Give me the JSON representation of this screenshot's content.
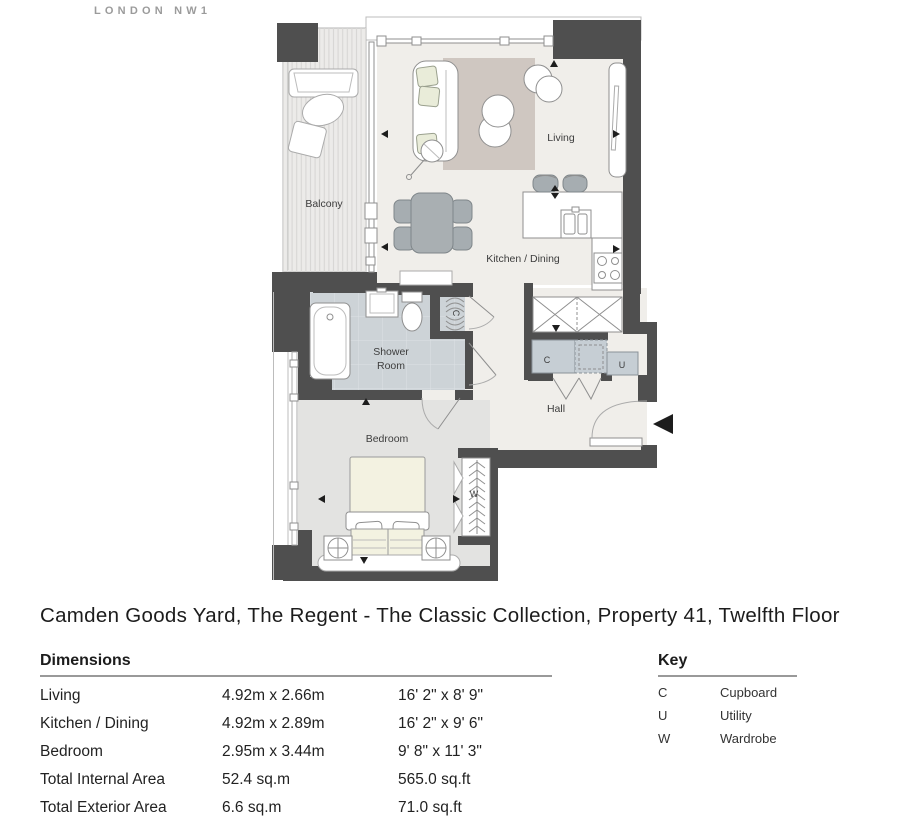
{
  "brand": {
    "location": "LONDON NW1"
  },
  "title": "Camden Goods Yard, The Regent - The Classic Collection, Property 41, Twelfth Floor",
  "plan": {
    "rooms": {
      "balcony": "Balcony",
      "living": "Living",
      "kitchen_dining": "Kitchen / Dining",
      "shower_line1": "Shower",
      "shower_line2": "Room",
      "bedroom": "Bedroom",
      "hall": "Hall"
    },
    "markers": {
      "closet_c": "C",
      "hall_cupboard_c": "C",
      "utility_u": "U",
      "wardrobe_w": "W"
    }
  },
  "dimensions": {
    "heading": "Dimensions",
    "rows": [
      {
        "label": "Living",
        "metric": "4.92m x 2.66m",
        "imperial": "16' 2\" x 8' 9\""
      },
      {
        "label": "Kitchen / Dining",
        "metric": "4.92m x 2.89m",
        "imperial": "16' 2\" x 9' 6\""
      },
      {
        "label": "Bedroom",
        "metric": "2.95m x 3.44m",
        "imperial": "9' 8\" x 11' 3\""
      },
      {
        "label": "Total Internal Area",
        "metric": "52.4 sq.m",
        "imperial": "565.0 sq.ft"
      },
      {
        "label": "Total Exterior Area",
        "metric": "6.6 sq.m",
        "imperial": "71.0 sq.ft"
      }
    ]
  },
  "key": {
    "heading": "Key",
    "items": [
      {
        "symbol": "C",
        "label": "Cupboard"
      },
      {
        "symbol": "U",
        "label": "Utility"
      },
      {
        "symbol": "W",
        "label": "Wardrobe"
      }
    ]
  },
  "colors": {
    "wall": "#4f4f4f",
    "floor": "#f0eeea",
    "tile_floor": "#cdd3d7",
    "bedroom_floor": "#e3e3e1",
    "balcony_floor": "#ecebe9",
    "rug": "#cfc7c1",
    "furniture_gray": "#a6adb1",
    "cupboard_gray": "#c6ced4",
    "ink": "#1c1c1c",
    "logo_gray": "#9b9b9b"
  }
}
